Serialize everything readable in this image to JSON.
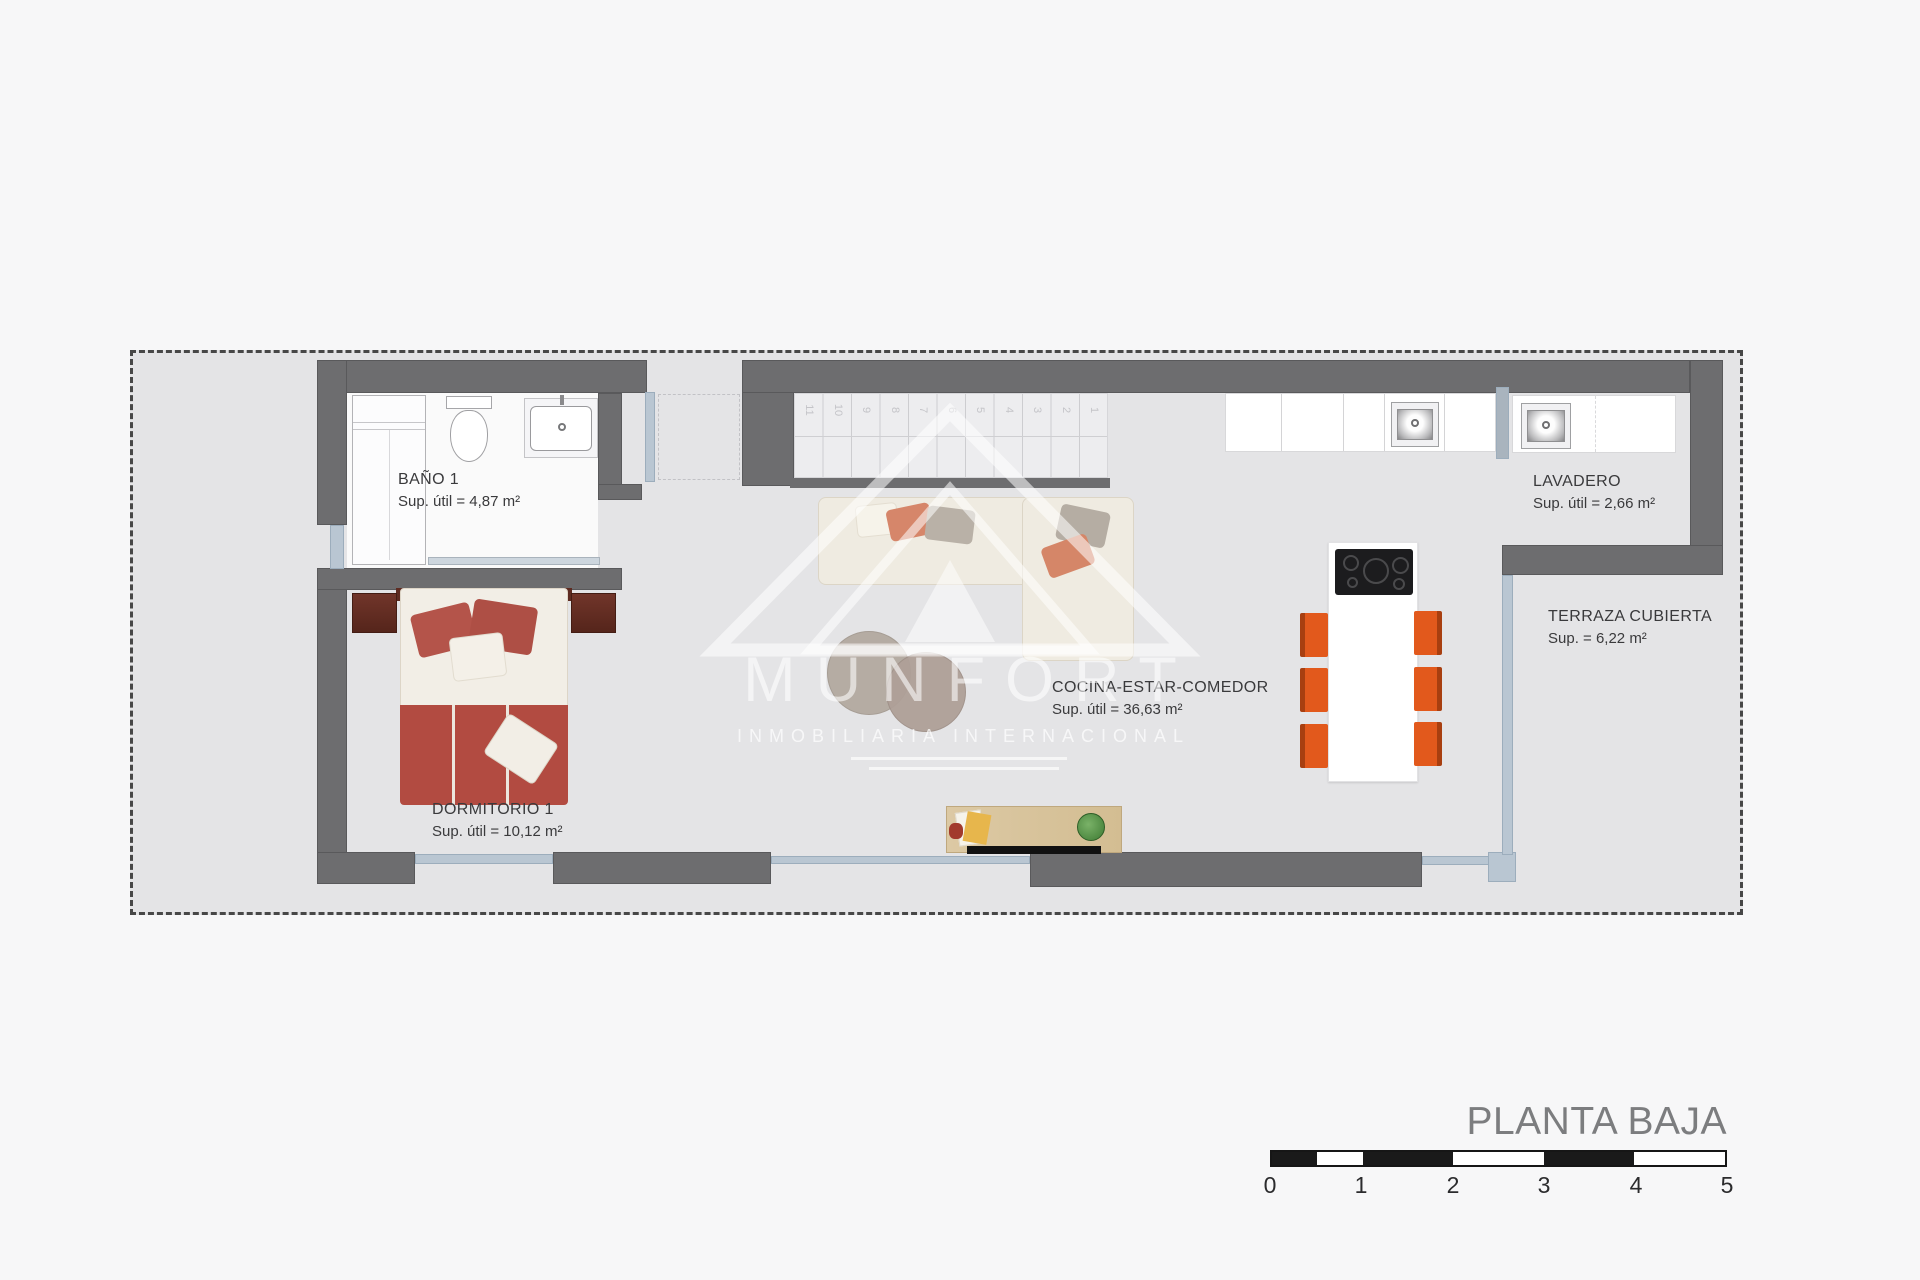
{
  "title": {
    "text": "PLANTA BAJA"
  },
  "watermark": {
    "brand": "MUNFORT",
    "tagline": "INMOBILIARIA INTERNACIONAL"
  },
  "rooms": {
    "bano1": {
      "name": "BAÑO 1",
      "area": "Sup. útil = 4,87 m²"
    },
    "dormitorio1": {
      "name": "DORMITORIO 1",
      "area": "Sup. útil = 10,12 m²"
    },
    "cocina": {
      "name": "COCINA-ESTAR-COMEDOR",
      "area": "Sup. útil = 36,63 m²"
    },
    "lavadero": {
      "name": "LAVADERO",
      "area": "Sup. útil = 2,66 m²"
    },
    "terraza": {
      "name": "TERRAZA CUBIERTA",
      "area": "Sup. = 6,22 m²"
    }
  },
  "stairs": {
    "steps": [
      "11",
      "10",
      "9",
      "8",
      "7",
      "6",
      "5",
      "4",
      "3",
      "2",
      "1"
    ]
  },
  "scale_bar": {
    "labels": [
      "0",
      "1",
      "2",
      "3",
      "4",
      "5"
    ]
  },
  "colors": {
    "wall": "#6d6d6f",
    "site_fill": "#e4e4e6",
    "window_glass": "#b9c6d2",
    "chair_orange": "#e2591c",
    "bed_red": "#b4544a",
    "title_gray": "#7c7d7f"
  }
}
